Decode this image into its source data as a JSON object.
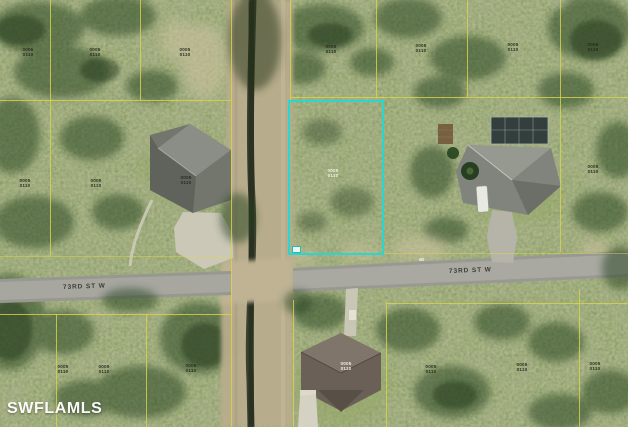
{
  "map": {
    "type": "aerial-parcel-map",
    "watermark": "SWFLAMLS",
    "streets": [
      {
        "name": "73RD ST W",
        "segment": "west-of-canal"
      },
      {
        "name": "73RD ST W",
        "segment": "east-of-canal"
      }
    ],
    "parcel_id_text": "0005 0110",
    "highlighted_lot": {
      "shape": "rectangle",
      "border_color": "#2BD6CF"
    },
    "parcel_line_color": "#DCD549"
  }
}
